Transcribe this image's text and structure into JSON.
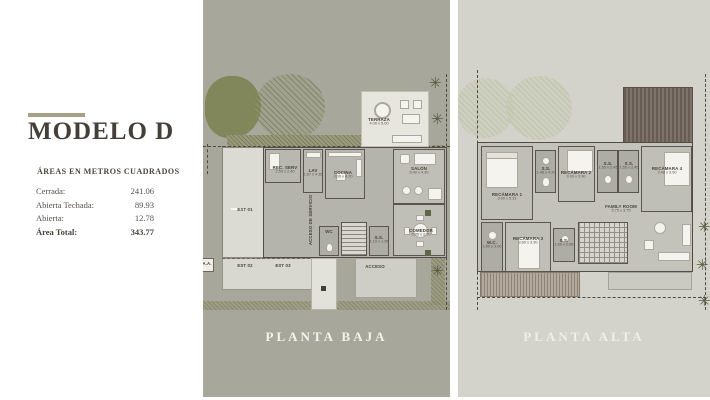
{
  "sidebar": {
    "title": "MODELO D",
    "subtitle": "ÁREAS EN METROS CUADRADOS",
    "area_rows": [
      {
        "label": "Cerrada:",
        "value": "241.06"
      },
      {
        "label": "Abierta Techada:",
        "value": "89.93"
      },
      {
        "label": "Abierta:",
        "value": "12.78"
      },
      {
        "label": "Área Total:",
        "value": "343.77"
      }
    ]
  },
  "planta_baja": {
    "caption": "PLANTA BAJA",
    "labels": {
      "terraza": {
        "name": "TERRAZA",
        "dims": "4.00 x 5.00"
      },
      "rec_serv": {
        "name": "REC. SERV",
        "dims": "2.55 x 2.40"
      },
      "lav": {
        "name": "LAV",
        "dims": "1.67 x 4.35"
      },
      "cocina": {
        "name": "COCINA",
        "dims": "3.00 x 4.20"
      },
      "salon": {
        "name": "SALON",
        "dims": "5.40 x 4.30"
      },
      "comedor": {
        "name": "COMEDOR",
        "dims": "5.05 x 2.70"
      },
      "ss": {
        "name": "S.S.",
        "dims": "1.10 x 1.95"
      },
      "wc": {
        "name": "WC"
      },
      "acceso_servicio": {
        "name": "ACCESO DE SERVICIO"
      },
      "acceso": {
        "name": "ACCESO"
      },
      "est01": {
        "name": "EST 01"
      },
      "est02": {
        "name": "EST 02"
      },
      "est03": {
        "name": "EST 03"
      },
      "aa": {
        "name": "A.A."
      }
    }
  },
  "planta_alta": {
    "caption": "PLANTA ALTA",
    "labels": {
      "recamara1": {
        "name": "RECÁMARA 1",
        "dims": "3.90 x 5.31"
      },
      "ss1": {
        "name": "S.S.",
        "dims": "1.48 x 4.20"
      },
      "recamara2": {
        "name": "RECÁMARA 2",
        "dims": "3.09 x 3.90"
      },
      "ss2": {
        "name": "S.S.",
        "dims": "1.55 x 2.45"
      },
      "ss3": {
        "name": "S.S.",
        "dims": "1.55 x 2.45"
      },
      "recamara4": {
        "name": "RECÁMARA 4",
        "dims": "3.48 x 3.90"
      },
      "family": {
        "name": "FAMILY ROOM",
        "dims": "5.75 x 3.75"
      },
      "wc": {
        "name": "W.C.",
        "dims": "1.80 x 3.00"
      },
      "recamara3": {
        "name": "RECÁMARA 3",
        "dims": "3.60 x 3.90"
      },
      "ss4": {
        "name": "S.S.",
        "dims": "1.60 x 2.85"
      }
    }
  },
  "colors": {
    "accent_bar": "#a79e86",
    "title_text": "#443f39",
    "panel_baja_bg": "#a8a79b",
    "panel_alta_bg": "#d4d3cb",
    "palm_green": "#565c40",
    "roof_brown": "#6e635a"
  },
  "icons": {
    "palm": "✳"
  }
}
